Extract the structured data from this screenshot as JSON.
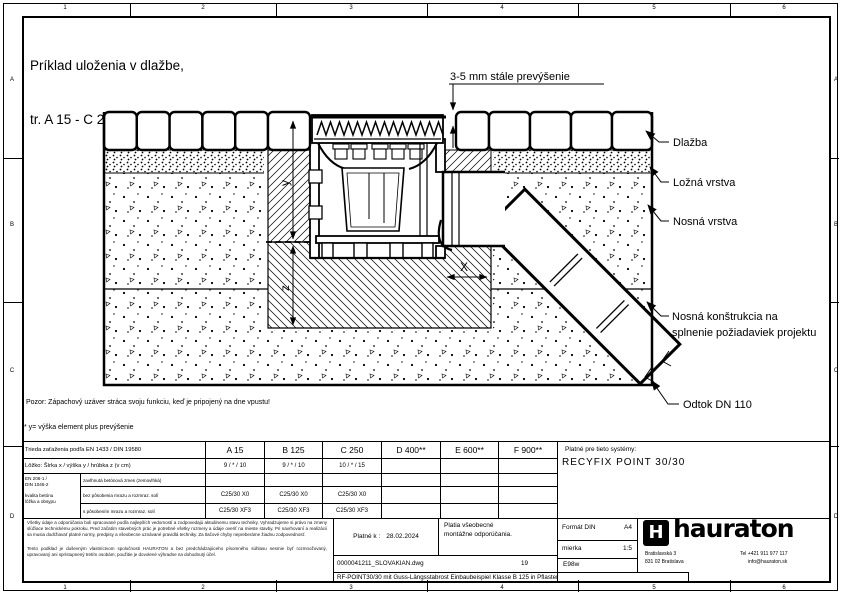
{
  "frame": {
    "cols": [
      "1",
      "2",
      "3",
      "4",
      "5",
      "6"
    ],
    "rows": [
      "A",
      "B",
      "C",
      "D"
    ]
  },
  "title": {
    "line1": "Príklad uloženia v dlažbe,",
    "line2": "tr. A 15 - C 250"
  },
  "drawing": {
    "top_note": "3-5 mm stále prevýšenie",
    "label_pavement": "Dlažba",
    "label_bedding": "Ložná vrstva",
    "label_base": "Nosná vrstva",
    "label_structure1": "Nosná konštrukcia na",
    "label_structure2": "splnenie požiadaviek projektu",
    "label_outlet": "Odtok DN 110",
    "dim_y": "y",
    "dim_z": "z",
    "dim_x": "X"
  },
  "notes": {
    "warning": "Pozor: Zápachový uzáver stráca svoju funkciu, keď je pripojený na dne vpustu!",
    "footnote": "* y= výška element plus prevýšenie"
  },
  "spec_table": {
    "load_row_label": "Trieda zaťaženia podľa EN 1433 / DIN 19580",
    "classes": [
      "A 15",
      "B 125",
      "C 250",
      "D 400**",
      "E 600**",
      "F 900**"
    ],
    "bedding_row_label": "Lôžko: Šírka x / výška y / hrúbka z (v cm)",
    "bedding_values": [
      "9 / * / 10",
      "9 / * / 10",
      "10 / * / 15",
      "",
      "",
      ""
    ],
    "concrete_std1": "EN 206-1 /",
    "concrete_std2": "DIN 1045-2",
    "concrete_std3": "kvalita betónu",
    "concrete_std4": "lôžka a obsypu",
    "row_moist_label": "zavlhnutá betónová zmes (zemovlhká)",
    "row_moist_values": [
      "",
      "",
      "",
      "",
      "",
      ""
    ],
    "row_nofrost_label": "bez pôsobenia mrazu a rozmraz. solí",
    "row_nofrost_values": [
      "C25/30 X0",
      "C25/30 X0",
      "C25/30 X0",
      "",
      "",
      ""
    ],
    "row_frost_label": "s pôsobením mrazu a rozmraz. solí",
    "row_frost_values": [
      "C25/30 XF3",
      "C25/30 XF3",
      "C25/30 XF3",
      "",
      "",
      ""
    ]
  },
  "title_block": {
    "systems_label": "Platné pre tieto systémy:",
    "system_name": "RECYFIX POINT 30/30",
    "fine_print_1": "Všetky údaje a odporúčania boli spracované podľa najlepších vedomostí a zodpovedajú aktuálnemu stavu techniky. Vyhradzujeme si právo na zmeny slúžiace technickému pokroku. Pred začatím stavebných prác je potrebné všetky rozmery a údaje overiť na mieste stavby. Pri navrhovaní a realizácii sa musia dodržiavať platné normy, predpisy a všeobecne uznávané pravidlá techniky. Za tlačové chyby nepreberáme žiadnu zodpovednosť.",
    "fine_print_2": "Tento podklad je duševným vlastníctvom spoločnosti HAURATON a bez predchádzajúceho písomného súhlasu nesmie byť rozmnožovaný, upravovaný ani sprístupnený tretím osobám; použitie je dovolené výhradne na dohodnutý účel.",
    "valid_label": "Platné k :",
    "valid_date": "28.02.2024",
    "general_note1": "Platia všeobecné",
    "general_note2": "montážne odporúčania.",
    "format_label": "Formát DIN",
    "format_value": "A4",
    "scale_label": "mierka",
    "scale_value": "1:5",
    "code": "E98w",
    "file_name": "0000041211_SLOVAKIAN.dwg",
    "sheet_no": "19",
    "description": "RF-POINT30/30 mit Guss-Längsstabrost  Einbaubeispiel Klasse B 125  in Pflaster",
    "company": {
      "name": "hauraton",
      "logo_letter": "H",
      "addr1": "Bratislavská 3",
      "addr2": "831 02 Bratislava",
      "phone": "Tel +421 911 977 117",
      "email": "info@hauraton.sk"
    }
  }
}
